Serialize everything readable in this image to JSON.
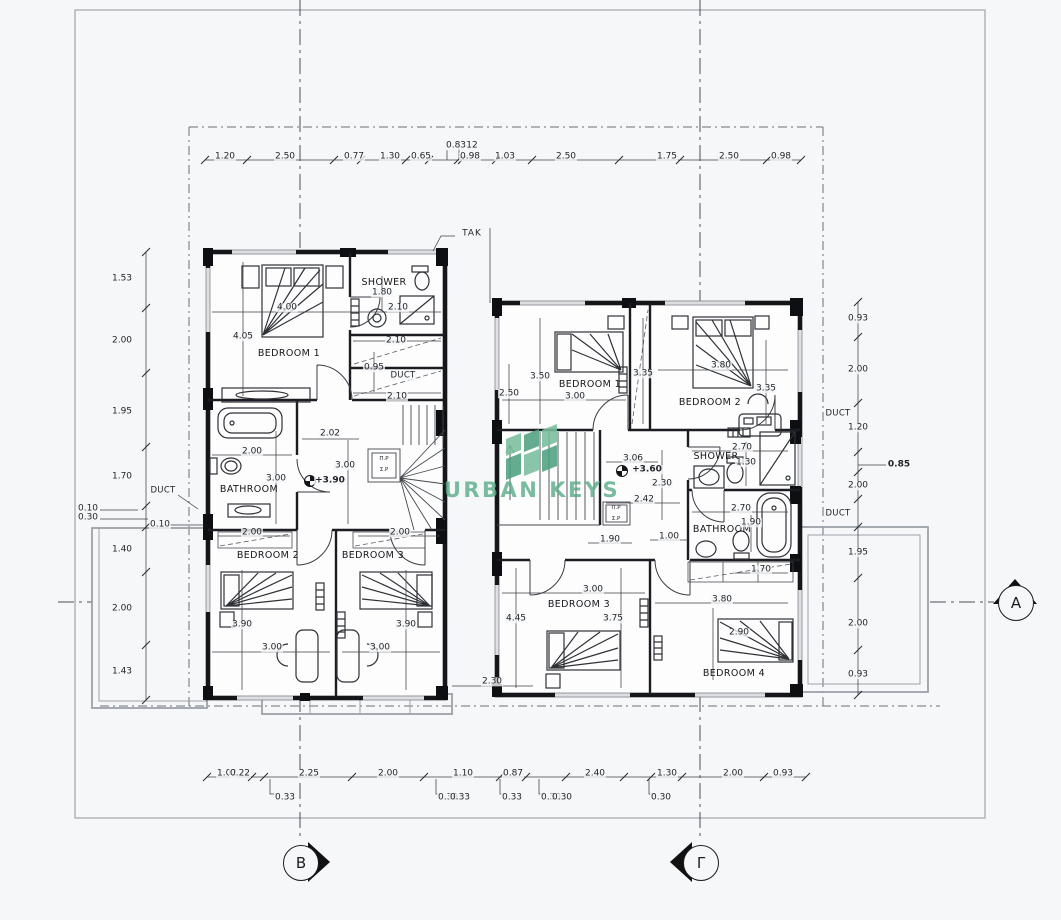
{
  "watermark": {
    "text": "URBAN KEYS",
    "color": "#58ab87",
    "logo_greens": [
      "#79bd9d",
      "#4ea181"
    ]
  },
  "markers": [
    {
      "label": "B"
    },
    {
      "label": "Γ"
    },
    {
      "label": "A"
    }
  ],
  "labels": [
    {
      "t": "BEDROOM 1",
      "x": 289,
      "y": 354,
      "c": "room"
    },
    {
      "t": "SHOWER",
      "x": 384,
      "y": 283,
      "c": "room"
    },
    {
      "t": "BATHROOM",
      "x": 249,
      "y": 490,
      "c": "room"
    },
    {
      "t": "BEDROOM 2",
      "x": 268,
      "y": 556,
      "c": "room"
    },
    {
      "t": "BEDROOM 3",
      "x": 373,
      "y": 556,
      "c": "room"
    },
    {
      "t": "BEDROOM 1",
      "x": 590,
      "y": 385,
      "c": "room"
    },
    {
      "t": "BEDROOM 2",
      "x": 710,
      "y": 403,
      "c": "room"
    },
    {
      "t": "SHOWER",
      "x": 716,
      "y": 457,
      "c": "room"
    },
    {
      "t": "BATHROOM",
      "x": 722,
      "y": 530,
      "c": "room"
    },
    {
      "t": "BEDROOM 3",
      "x": 579,
      "y": 605,
      "c": "room"
    },
    {
      "t": "BEDROOM 4",
      "x": 734,
      "y": 674,
      "c": "room"
    },
    {
      "t": "DUCT",
      "x": 403,
      "y": 376,
      "c": "duct"
    },
    {
      "t": "DUCT",
      "x": 163,
      "y": 491,
      "c": "duct"
    },
    {
      "t": "DUCT",
      "x": 838,
      "y": 414,
      "c": "duct"
    },
    {
      "t": "DUCT",
      "x": 838,
      "y": 514,
      "c": "duct"
    },
    {
      "t": "TAK",
      "x": 472,
      "y": 234,
      "c": "tak"
    },
    {
      "t": "+3.90",
      "x": 330,
      "y": 481,
      "c": "level"
    },
    {
      "t": "+3.60",
      "x": 647,
      "y": 470,
      "c": "level"
    },
    {
      "t": "Π.Ρ",
      "x": 384,
      "y": 460,
      "c": "tiny"
    },
    {
      "t": "Σ.Ρ",
      "x": 384,
      "y": 471,
      "c": "tiny"
    },
    {
      "t": "Π.Ρ",
      "x": 616,
      "y": 509,
      "c": "tiny"
    },
    {
      "t": "Σ.Ρ",
      "x": 616,
      "y": 520,
      "c": "tiny"
    },
    {
      "t": "1.20",
      "x": 225,
      "y": 157,
      "c": "dim"
    },
    {
      "t": "2.50",
      "x": 285,
      "y": 157,
      "c": "dim"
    },
    {
      "t": "0.77",
      "x": 354,
      "y": 157,
      "c": "dim"
    },
    {
      "t": "1.30",
      "x": 390,
      "y": 157,
      "c": "dim"
    },
    {
      "t": "0.65",
      "x": 421,
      "y": 157,
      "c": "dim"
    },
    {
      "t": "0.83",
      "x": 456,
      "y": 146,
      "c": "dim"
    },
    {
      "t": "12",
      "x": 472,
      "y": 146,
      "c": "dim"
    },
    {
      "t": "0.98",
      "x": 470,
      "y": 157,
      "c": "dim"
    },
    {
      "t": "1.03",
      "x": 505,
      "y": 157,
      "c": "dim"
    },
    {
      "t": "2.50",
      "x": 566,
      "y": 157,
      "c": "dim"
    },
    {
      "t": "1.75",
      "x": 667,
      "y": 157,
      "c": "dim"
    },
    {
      "t": "2.50",
      "x": 729,
      "y": 157,
      "c": "dim"
    },
    {
      "t": "0.98",
      "x": 781,
      "y": 157,
      "c": "dim"
    },
    {
      "t": "1.02",
      "x": 227,
      "y": 774,
      "c": "dim"
    },
    {
      "t": "0.22",
      "x": 240,
      "y": 774,
      "c": "dim"
    },
    {
      "t": "2.25",
      "x": 309,
      "y": 774,
      "c": "dim"
    },
    {
      "t": "2.00",
      "x": 388,
      "y": 774,
      "c": "dim"
    },
    {
      "t": "1.10",
      "x": 463,
      "y": 774,
      "c": "dim"
    },
    {
      "t": "0.87",
      "x": 513,
      "y": 774,
      "c": "dim"
    },
    {
      "t": "2.40",
      "x": 595,
      "y": 774,
      "c": "dim"
    },
    {
      "t": "1.30",
      "x": 667,
      "y": 774,
      "c": "dim"
    },
    {
      "t": "2.00",
      "x": 733,
      "y": 774,
      "c": "dim"
    },
    {
      "t": "0.93",
      "x": 783,
      "y": 774,
      "c": "dim"
    },
    {
      "t": "0.33",
      "x": 285,
      "y": 798,
      "c": "dim"
    },
    {
      "t": "0.30",
      "x": 448,
      "y": 798,
      "c": "dim"
    },
    {
      "t": "0.33",
      "x": 460,
      "y": 798,
      "c": "dim"
    },
    {
      "t": "0.33",
      "x": 512,
      "y": 798,
      "c": "dim"
    },
    {
      "t": "0.30",
      "x": 551,
      "y": 798,
      "c": "dim"
    },
    {
      "t": "0.30",
      "x": 562,
      "y": 798,
      "c": "dim"
    },
    {
      "t": "0.30",
      "x": 661,
      "y": 798,
      "c": "dim"
    },
    {
      "t": "1.53",
      "x": 122,
      "y": 279,
      "c": "dim"
    },
    {
      "t": "2.00",
      "x": 122,
      "y": 341,
      "c": "dim"
    },
    {
      "t": "1.95",
      "x": 122,
      "y": 412,
      "c": "dim"
    },
    {
      "t": "1.70",
      "x": 122,
      "y": 477,
      "c": "dim"
    },
    {
      "t": "1.40",
      "x": 122,
      "y": 550,
      "c": "dim"
    },
    {
      "t": "2.00",
      "x": 122,
      "y": 609,
      "c": "dim"
    },
    {
      "t": "1.43",
      "x": 122,
      "y": 672,
      "c": "dim"
    },
    {
      "t": "0.10",
      "x": 88,
      "y": 509,
      "c": "dim"
    },
    {
      "t": "0.30",
      "x": 88,
      "y": 518,
      "c": "dim"
    },
    {
      "t": "0.10",
      "x": 160,
      "y": 525,
      "c": "dim"
    },
    {
      "t": "0.93",
      "x": 858,
      "y": 319,
      "c": "dim"
    },
    {
      "t": "2.00",
      "x": 858,
      "y": 370,
      "c": "dim"
    },
    {
      "t": "1.20",
      "x": 858,
      "y": 428,
      "c": "dim"
    },
    {
      "t": "0.85",
      "x": 899,
      "y": 465,
      "c": "dimb"
    },
    {
      "t": "2.00",
      "x": 858,
      "y": 486,
      "c": "dim"
    },
    {
      "t": "1.95",
      "x": 858,
      "y": 553,
      "c": "dim"
    },
    {
      "t": "2.00",
      "x": 858,
      "y": 624,
      "c": "dim"
    },
    {
      "t": "0.93",
      "x": 858,
      "y": 675,
      "c": "dim"
    },
    {
      "t": "1.80",
      "x": 382,
      "y": 293,
      "c": "dim"
    },
    {
      "t": "4.00",
      "x": 287,
      "y": 308,
      "c": "dim"
    },
    {
      "t": "2.10",
      "x": 398,
      "y": 308,
      "c": "dim"
    },
    {
      "t": "4.05",
      "x": 243,
      "y": 337,
      "c": "dim"
    },
    {
      "t": "2.10",
      "x": 396,
      "y": 341,
      "c": "dim"
    },
    {
      "t": "0.95",
      "x": 374,
      "y": 368,
      "c": "dim"
    },
    {
      "t": "2.10",
      "x": 397,
      "y": 397,
      "c": "dim"
    },
    {
      "t": "2.02",
      "x": 330,
      "y": 434,
      "c": "dim"
    },
    {
      "t": "2.00",
      "x": 252,
      "y": 452,
      "c": "dim"
    },
    {
      "t": "3.00",
      "x": 345,
      "y": 466,
      "c": "dim"
    },
    {
      "t": "3.00",
      "x": 276,
      "y": 479,
      "c": "dim"
    },
    {
      "t": "2.00",
      "x": 252,
      "y": 533,
      "c": "dim"
    },
    {
      "t": "2.00",
      "x": 400,
      "y": 533,
      "c": "dim"
    },
    {
      "t": "3.90",
      "x": 242,
      "y": 625,
      "c": "dim"
    },
    {
      "t": "3.90",
      "x": 406,
      "y": 625,
      "c": "dim"
    },
    {
      "t": "3.00",
      "x": 272,
      "y": 648,
      "c": "dim"
    },
    {
      "t": "3.00",
      "x": 380,
      "y": 648,
      "c": "dim"
    },
    {
      "t": "2.50",
      "x": 509,
      "y": 394,
      "c": "dim"
    },
    {
      "t": "3.50",
      "x": 540,
      "y": 377,
      "c": "dim"
    },
    {
      "t": "3.00",
      "x": 575,
      "y": 397,
      "c": "dim"
    },
    {
      "t": "3.35",
      "x": 643,
      "y": 374,
      "c": "dim"
    },
    {
      "t": "3.80",
      "x": 721,
      "y": 366,
      "c": "dim"
    },
    {
      "t": "3.35",
      "x": 766,
      "y": 389,
      "c": "dim"
    },
    {
      "t": "2.70",
      "x": 742,
      "y": 448,
      "c": "dim"
    },
    {
      "t": "1.30",
      "x": 746,
      "y": 463,
      "c": "dim"
    },
    {
      "t": "3.06",
      "x": 633,
      "y": 459,
      "c": "dim"
    },
    {
      "t": "2.30",
      "x": 662,
      "y": 484,
      "c": "dim"
    },
    {
      "t": "2.42",
      "x": 644,
      "y": 500,
      "c": "dim"
    },
    {
      "t": "2.70",
      "x": 741,
      "y": 509,
      "c": "dim"
    },
    {
      "t": "1.90",
      "x": 751,
      "y": 523,
      "c": "dim"
    },
    {
      "t": "1.90",
      "x": 610,
      "y": 540,
      "c": "dim"
    },
    {
      "t": "1.00",
      "x": 669,
      "y": 537,
      "c": "dim"
    },
    {
      "t": "1.70",
      "x": 761,
      "y": 570,
      "c": "dim"
    },
    {
      "t": "3.00",
      "x": 593,
      "y": 590,
      "c": "dim"
    },
    {
      "t": "3.80",
      "x": 722,
      "y": 600,
      "c": "dim"
    },
    {
      "t": "4.45",
      "x": 516,
      "y": 619,
      "c": "dim"
    },
    {
      "t": "3.75",
      "x": 613,
      "y": 619,
      "c": "dim"
    },
    {
      "t": "2.90",
      "x": 739,
      "y": 633,
      "c": "dim"
    },
    {
      "t": "2.30",
      "x": 492,
      "y": 682,
      "c": "dim"
    }
  ]
}
